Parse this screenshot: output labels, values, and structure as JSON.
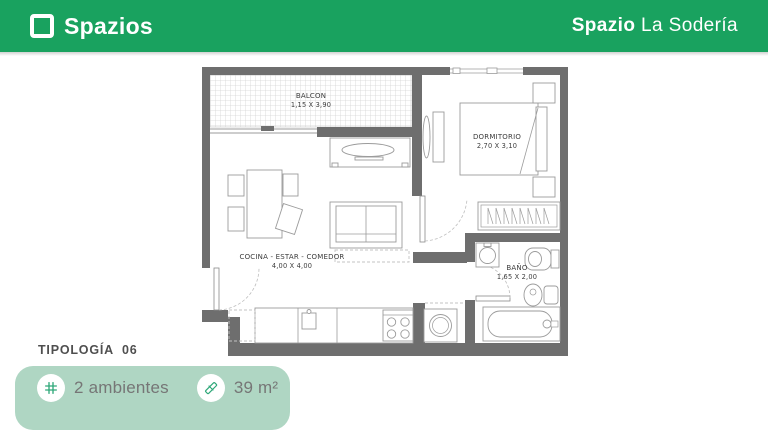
{
  "header": {
    "brand": "Spazios",
    "project": {
      "bold": "Spazio",
      "rest": " La Sodería"
    }
  },
  "floorplan": {
    "rooms": [
      {
        "id": "balcon",
        "name": "BALCON",
        "dims": "1,15 X 3,90"
      },
      {
        "id": "dormitorio",
        "name": "DORMITORIO",
        "dims": "2,70 X 3,10"
      },
      {
        "id": "cocina",
        "name": "COCINA - ESTAR - COMEDOR",
        "dims": "4,00 X 4,00"
      },
      {
        "id": "bano",
        "name": "BAÑO",
        "dims": "1,65 X 2,00"
      }
    ]
  },
  "footer": {
    "typology": "TIPOLOGÍA  06",
    "features": [
      {
        "icon": "grid-icon",
        "label": "2 ambientes"
      },
      {
        "icon": "ruler-icon",
        "label": "39 m²"
      }
    ]
  },
  "colors": {
    "header_green": "#19A25F",
    "card_mint": "#AFD6C3",
    "wall_gray": "#6E6E6E",
    "furniture_line": "#9B9B9B"
  }
}
